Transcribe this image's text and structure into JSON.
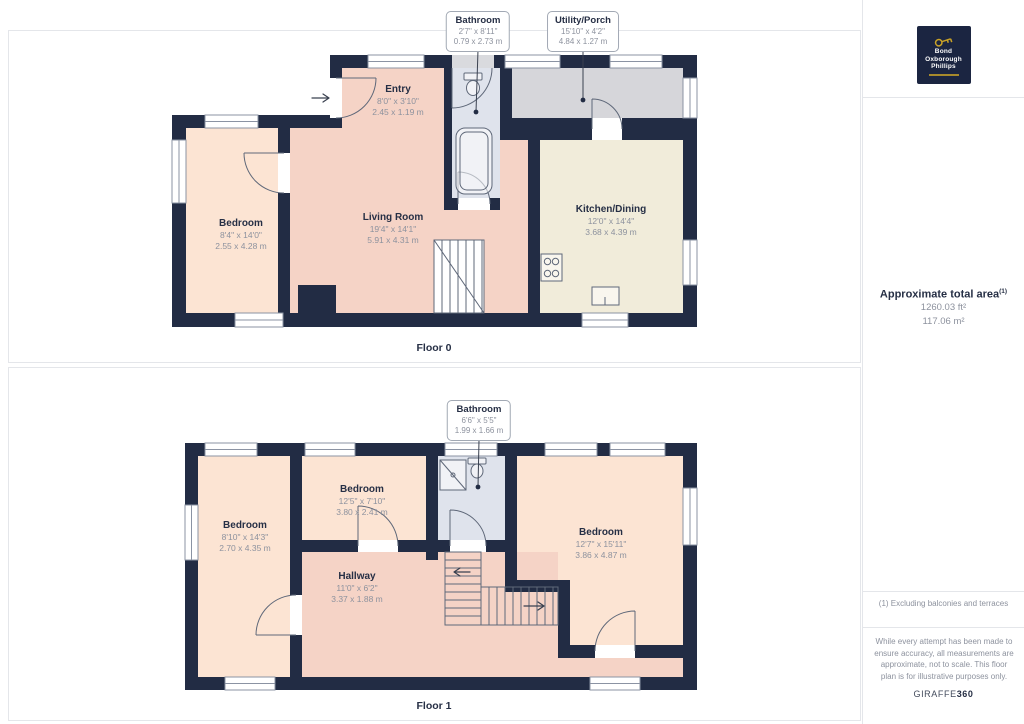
{
  "colors": {
    "wall": "#222c44",
    "peach": "#fce4d3",
    "pink": "#f5d3c6",
    "cream": "#f1ecda",
    "bathblue": "#dfe3ec",
    "grey": "#d6d6da",
    "frame": "#8b93a3",
    "line": "#5f6879",
    "panel-border": "#e4e6ea",
    "text-dark": "#262f45",
    "text-grey": "#8d929e",
    "gold": "#c9a227",
    "navy": "#1b2541"
  },
  "floor0": {
    "label": "Floor 0",
    "callouts": [
      {
        "title": "Bathroom",
        "dim_ft": "2'7\" x 8'11\"",
        "dim_m": "0.79 x 2.73 m"
      },
      {
        "title": "Utility/Porch",
        "dim_ft": "15'10\" x 4'2\"",
        "dim_m": "4.84 x 1.27 m"
      }
    ],
    "rooms": [
      {
        "name": "Bedroom",
        "dim_ft": "8'4\" x 14'0\"",
        "dim_m": "2.55 x 4.28 m"
      },
      {
        "name": "Living Room",
        "dim_ft": "19'4\" x 14'1\"",
        "dim_m": "5.91 x 4.31 m"
      },
      {
        "name": "Entry",
        "dim_ft": "8'0\" x 3'10\"",
        "dim_m": "2.45 x 1.19 m"
      },
      {
        "name": "Kitchen/Dining",
        "dim_ft": "12'0\" x 14'4\"",
        "dim_m": "3.68 x 4.39 m"
      }
    ]
  },
  "floor1": {
    "label": "Floor 1",
    "callouts": [
      {
        "title": "Bathroom",
        "dim_ft": "6'6\" x 5'5\"",
        "dim_m": "1.99 x 1.66 m"
      }
    ],
    "rooms": [
      {
        "name": "Bedroom",
        "dim_ft": "8'10\" x 14'3\"",
        "dim_m": "2.70 x 4.35 m"
      },
      {
        "name": "Bedroom",
        "dim_ft": "12'5\" x 7'10\"",
        "dim_m": "3.80 x 2.41 m"
      },
      {
        "name": "Bedroom",
        "dim_ft": "12'7\" x 15'11\"",
        "dim_m": "3.86 x 4.87 m"
      },
      {
        "name": "Hallway",
        "dim_ft": "11'0\" x 6'2\"",
        "dim_m": "3.37 x 1.88 m"
      }
    ]
  },
  "sidebar": {
    "logo": {
      "line1": "Bond",
      "line2": "Oxborough",
      "line3": "Phillips"
    },
    "area_title": "Approximate total area",
    "area_sup": "(1)",
    "area_ft": "1260.03 ft²",
    "area_m": "117.06 m²",
    "footnote": "(1) Excluding balconies and terraces",
    "disclaimer": "While every attempt has been made to ensure accuracy, all measurements are approximate, not to scale. This floor plan is for illustrative purposes only.",
    "brand": "GIRAFFE",
    "brand_bold": "360"
  }
}
